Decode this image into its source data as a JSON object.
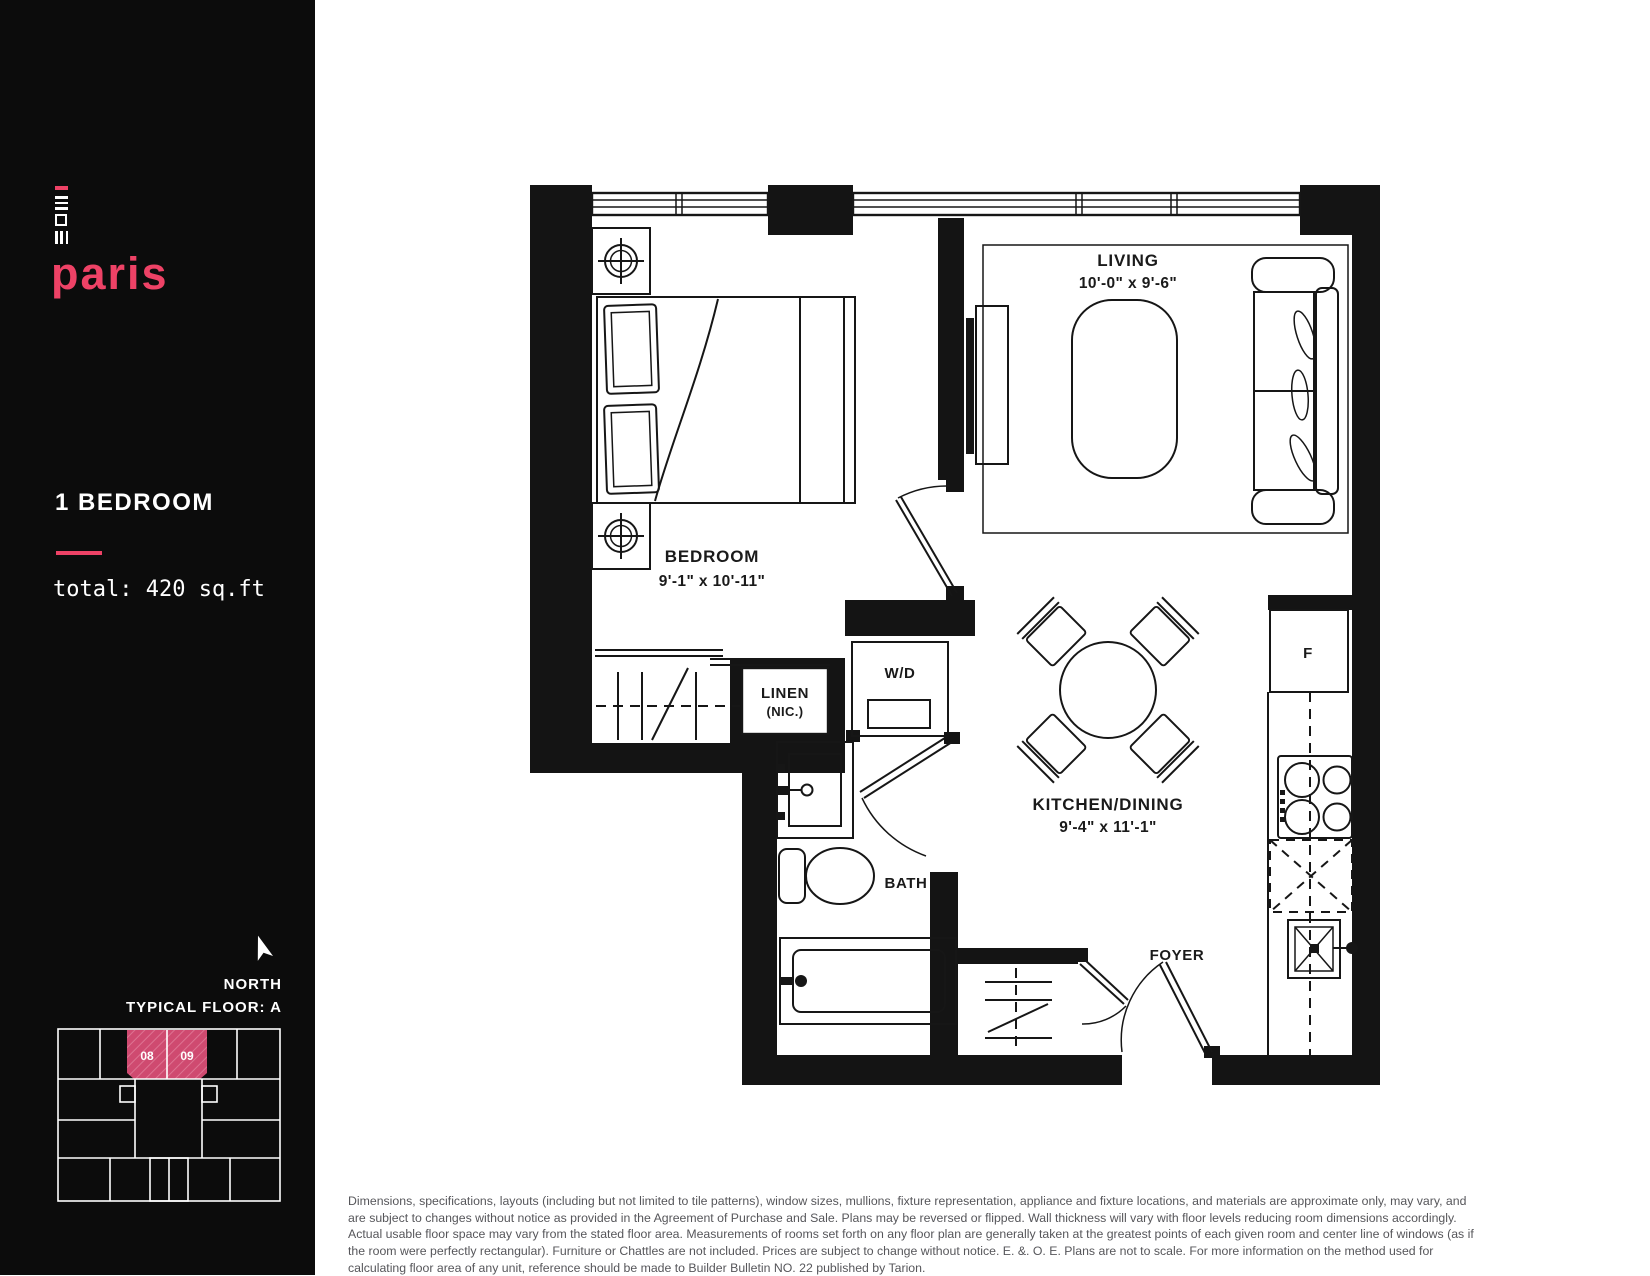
{
  "sidebar": {
    "brand": "paris",
    "unit_type": "1 BEDROOM",
    "total_area": "total: 420 sq.ft",
    "north_label": "NORTH",
    "floor_label": "TYPICAL FLOOR: A",
    "keyplan": {
      "unit_left": "08",
      "unit_right": "09"
    }
  },
  "plan": {
    "rooms": {
      "living": {
        "name": "LIVING",
        "dims": "10'-0\" x 9'-6\""
      },
      "bedroom": {
        "name": "BEDROOM",
        "dims": "9'-1\" x 10'-11\""
      },
      "kitchen": {
        "name": "KITCHEN/DINING",
        "dims": "9'-4\" x 11'-1\""
      },
      "bath": {
        "name": "BATH"
      },
      "foyer": {
        "name": "FOYER"
      }
    },
    "fixtures": {
      "washer_dryer": "W/D",
      "linen_line1": "LINEN",
      "linen_line2": "(NIC.)",
      "fridge": "F"
    }
  },
  "colors": {
    "accent": "#ee4266",
    "sidebar_bg": "#0c0c0c",
    "keyplan_fill": "#cf4a70",
    "keyplan_hatch": "#de7392"
  },
  "disclaimer": "Dimensions, specifications, layouts (including but not limited to tile patterns), window sizes, mullions, fixture representation, appliance and fixture locations, and materials are approximate only, may vary, and are subject to changes without notice as provided in the Agreement of Purchase and Sale. Plans may be reversed or flipped. Wall thickness will vary with floor levels reducing room dimensions accordingly. Actual usable floor space may vary from the stated floor area. Measurements of rooms set forth on any floor plan are generally taken at the greatest points of each given room and center line of windows (as if the room were perfectly rectangular). Furniture or Chattles are not included. Prices are subject to change without notice. E. &. O. E. Plans are not to scale. For more information on the method used for calculating floor area of any unit, reference should be made to Builder Bulletin NO. 22 published by Tarion."
}
